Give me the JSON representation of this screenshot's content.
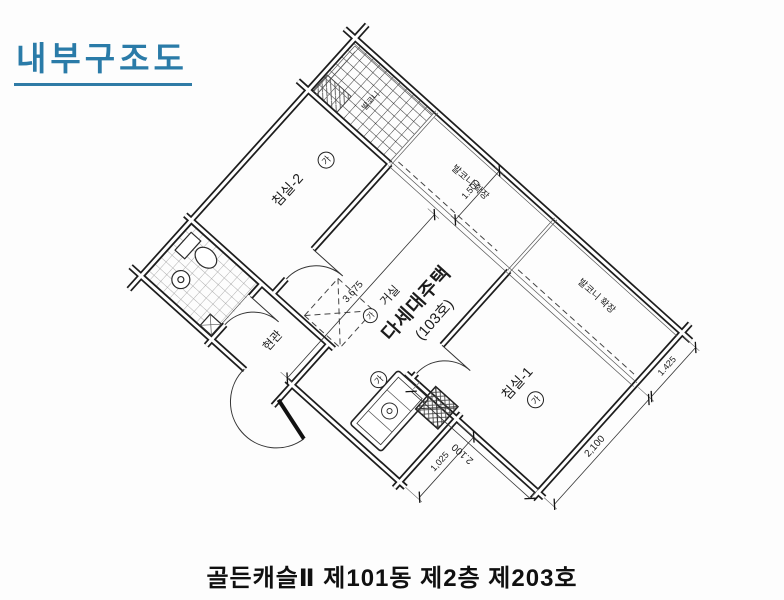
{
  "title": {
    "text": "내부구조도"
  },
  "caption": {
    "text": "골든캐슬Ⅱ 제101동 제2층 제203호"
  },
  "colors": {
    "title_blue": "#2a7ba8",
    "ink": "#1e1e1e",
    "paper": "#fdfdfd"
  },
  "plan": {
    "unit_label": {
      "mark": "가",
      "room": "거실",
      "line2": "다세대주택",
      "line3": "(103호)"
    },
    "bedroom2": {
      "label": "침실-2",
      "mark": "가"
    },
    "bedroom1": {
      "label": "침실-1",
      "mark": "가"
    },
    "entrance_label": "현관",
    "balcony_label": "발코니",
    "balcony_ext_living": "발코니 확장",
    "balcony_ext_bedroom1": "발코니 확장",
    "kitchen_mark": "가",
    "dims": {
      "living_width": "3.675",
      "balcony_top": "1.500",
      "bedroom1_left": "2.100",
      "kitchen_bottom": "1,025",
      "bedroom1_bottom": "2,100",
      "balcony_bottom": "1.425"
    }
  }
}
